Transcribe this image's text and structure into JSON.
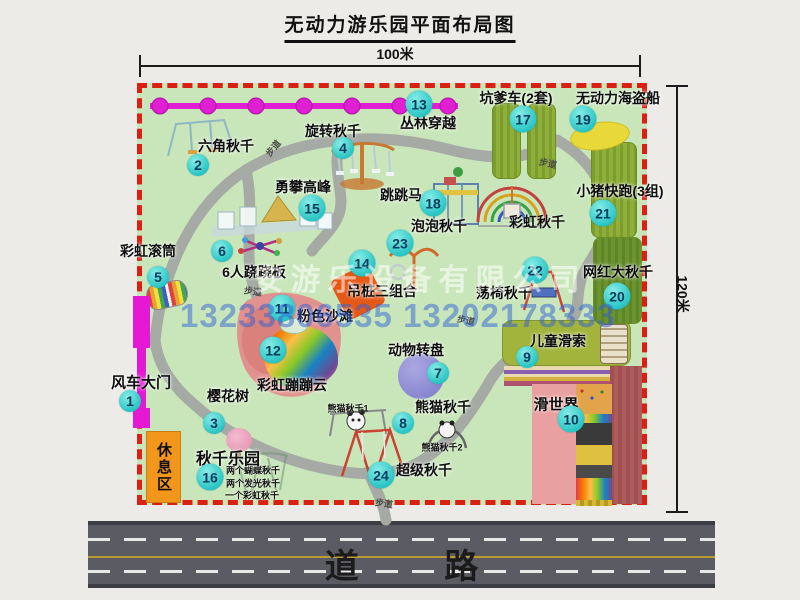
{
  "title": "无动力游乐园平面布局图",
  "dimensions": {
    "top": "100米",
    "right": "120米"
  },
  "road_label": "道 路",
  "rest_area_label": "休息区",
  "watermark": {
    "company": "安游乐设备有限公司",
    "phone": "13233806535 13202178333"
  },
  "colors": {
    "park_green": "#c9e6ba",
    "border_red": "#da1f15",
    "badge_teal": "#2cc6c6",
    "gate_magenta": "#e519d4",
    "road_gray": "#5b5b63",
    "rest_orange": "#f2971c",
    "mat_green": "#8fae3a",
    "watermark_blue": "#2f60d6"
  },
  "pois": [
    {
      "num": "1",
      "label": "风车大门",
      "badge": [
        130,
        401
      ],
      "lab": [
        141,
        382
      ],
      "fs": 15
    },
    {
      "num": "2",
      "label": "六角秋千",
      "badge": [
        198,
        165
      ],
      "lab": [
        226,
        146
      ]
    },
    {
      "num": "3",
      "label": "樱花树",
      "badge": [
        214,
        423
      ],
      "lab": [
        228,
        396
      ]
    },
    {
      "num": "4",
      "label": "旋转秋千",
      "badge": [
        343,
        148
      ],
      "lab": [
        333,
        131
      ]
    },
    {
      "num": "5",
      "label": "彩虹滚筒",
      "badge": [
        158,
        277
      ],
      "lab": [
        148,
        251
      ]
    },
    {
      "num": "6",
      "label": "6人跷跷板",
      "badge": [
        222,
        251
      ],
      "lab": [
        254,
        272
      ]
    },
    {
      "num": "7",
      "label": "动物转盘",
      "badge": [
        438,
        373
      ],
      "lab": [
        416,
        350
      ]
    },
    {
      "num": "8",
      "label": "熊猫秋千",
      "badge": [
        403,
        423
      ],
      "lab": [
        443,
        407
      ]
    },
    {
      "num": "9",
      "label": "儿童滑索",
      "badge": [
        527,
        357
      ],
      "lab": [
        558,
        341
      ]
    },
    {
      "num": "10",
      "label": "滑世界",
      "badge": [
        571,
        419
      ],
      "lab": [
        556,
        404
      ],
      "fs": 15
    },
    {
      "num": "11",
      "label": "粉色沙滩",
      "badge": [
        282,
        308
      ],
      "lab": [
        325,
        316
      ]
    },
    {
      "num": "12",
      "label": "彩虹蹦蹦云",
      "badge": [
        273,
        350
      ],
      "lab": [
        292,
        385
      ]
    },
    {
      "num": "13",
      "label": "丛林穿越",
      "badge": [
        419,
        104
      ],
      "lab": [
        428,
        123
      ]
    },
    {
      "num": "14",
      "label": "吊桩三组合",
      "badge": [
        362,
        263
      ],
      "lab": [
        382,
        291
      ]
    },
    {
      "num": "15",
      "label": "勇攀高峰",
      "badge": [
        312,
        208
      ],
      "lab": [
        303,
        187
      ]
    },
    {
      "num": "16",
      "label": "秋千乐园",
      "badge": [
        210,
        477
      ],
      "lab": [
        228,
        457
      ],
      "fs": 16
    },
    {
      "num": "17",
      "label": "坑爹车(2套)",
      "badge": [
        523,
        119
      ],
      "lab": [
        516,
        98
      ]
    },
    {
      "num": "18",
      "label": "跳跳马",
      "badge": [
        433,
        203
      ],
      "lab": [
        401,
        195
      ]
    },
    {
      "num": "19",
      "label": "无动力海盗船",
      "badge": [
        583,
        119
      ],
      "lab": [
        618,
        98
      ]
    },
    {
      "num": "20",
      "label": "网红大秋千",
      "badge": [
        617,
        296
      ],
      "lab": [
        618,
        272
      ]
    },
    {
      "num": "21",
      "label": "小猪快跑(3组)",
      "badge": [
        603,
        213
      ],
      "lab": [
        620,
        191
      ]
    },
    {
      "num": "22",
      "label": "荡椅秋千",
      "badge": [
        535,
        270
      ],
      "lab": [
        504,
        293
      ]
    },
    {
      "num": "23",
      "label": "泡泡秋千",
      "badge": [
        400,
        243
      ],
      "lab": [
        439,
        226
      ]
    },
    {
      "num": "24",
      "label": "超级秋千",
      "badge": [
        381,
        475
      ],
      "lab": [
        424,
        470
      ]
    }
  ],
  "extra_labels": [
    {
      "name": "rainbow-swing-label",
      "text": "彩虹秋千",
      "x": 537,
      "y": 222,
      "fs": 14
    },
    {
      "name": "panda-swing-1-label",
      "text": "熊猫秋千1",
      "x": 348,
      "y": 408,
      "fs": 9
    },
    {
      "name": "panda-swing-2-label",
      "text": "熊猫秋千2",
      "x": 442,
      "y": 447,
      "fs": 9
    },
    {
      "name": "swing-park-note-1",
      "text": "两个蝴蝶秋千",
      "x": 253,
      "y": 470,
      "fs": 9
    },
    {
      "name": "swing-park-note-2",
      "text": "两个发光秋千",
      "x": 253,
      "y": 483,
      "fs": 9
    },
    {
      "name": "swing-park-note-3",
      "text": "一个彩虹秋千",
      "x": 252,
      "y": 495,
      "fs": 9
    }
  ],
  "walkway_label": "步道",
  "walkway_label_spots": [
    {
      "x": 273,
      "y": 148,
      "r": -50
    },
    {
      "x": 548,
      "y": 163,
      "r": 12
    },
    {
      "x": 253,
      "y": 291,
      "r": 8
    },
    {
      "x": 466,
      "y": 320,
      "r": 12
    },
    {
      "x": 384,
      "y": 503,
      "r": 8
    }
  ]
}
